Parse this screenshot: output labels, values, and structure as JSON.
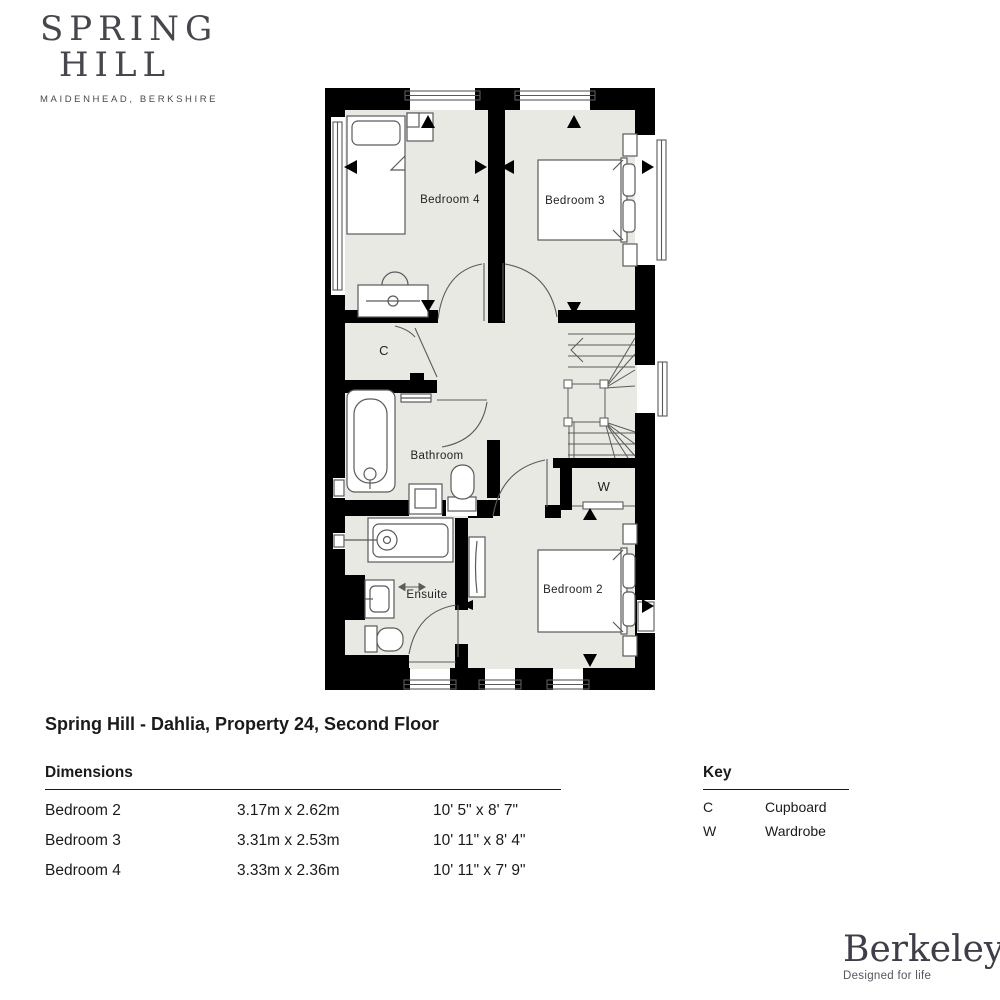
{
  "brand": {
    "line1": "SPRING",
    "line2": "HILL",
    "tagline": "MAIDENHEAD, BERKSHIRE"
  },
  "plan": {
    "labels": {
      "bedroom4": "Bedroom 4",
      "bedroom3": "Bedroom 3",
      "bedroom2": "Bedroom 2",
      "bathroom": "Bathroom",
      "ensuite": "Ensuite",
      "cupboard": "C",
      "wardrobe": "W"
    }
  },
  "title": "Spring Hill - Dahlia, Property 24, Second Floor",
  "dimensions": {
    "heading": "Dimensions",
    "rows": [
      {
        "room": "Bedroom 2",
        "metric": "3.17m x 2.62m",
        "imperial": "10' 5\" x 8' 7\""
      },
      {
        "room": "Bedroom 3",
        "metric": "3.31m x 2.53m",
        "imperial": "10' 11\" x 8' 4\""
      },
      {
        "room": "Bedroom 4",
        "metric": "3.33m x 2.36m",
        "imperial": "10' 11\" x 7' 9\""
      }
    ]
  },
  "key": {
    "heading": "Key",
    "entries": [
      {
        "symbol": "C",
        "label": "Cupboard"
      },
      {
        "symbol": "W",
        "label": "Wardrobe"
      }
    ]
  },
  "footer": {
    "brand": "Berkeley",
    "tagline": "Designed for life"
  },
  "colors": {
    "wall": "#000000",
    "floor": "#e9e9e4",
    "fixture": "#5a5a5a"
  }
}
